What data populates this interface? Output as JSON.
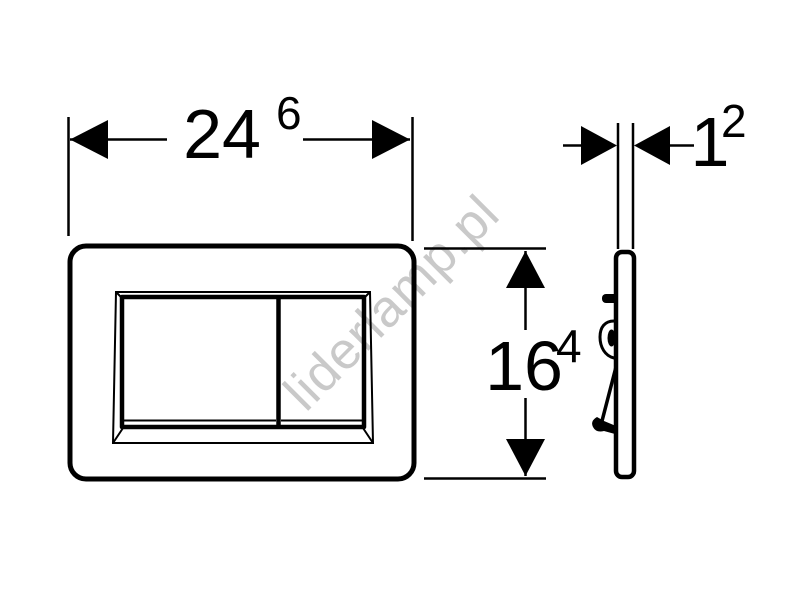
{
  "diagram": {
    "watermark": {
      "text": "liderlamp.pl",
      "color": "#c9c9c9"
    },
    "colors": {
      "line": "#000000",
      "background": "#ffffff"
    },
    "dimensions": {
      "width": {
        "value": "24",
        "sup": "6"
      },
      "height": {
        "value": "16",
        "sup": "4"
      },
      "depth": {
        "value": "1",
        "sup": "2"
      }
    }
  }
}
